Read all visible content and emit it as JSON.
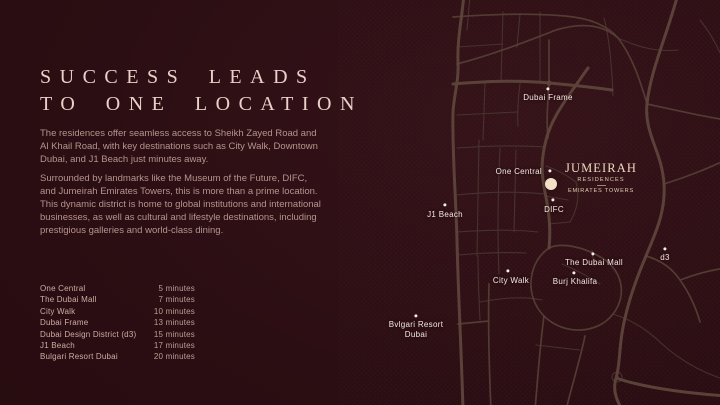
{
  "colors": {
    "background": "#2b0e13",
    "headline_text": "#e9d0c9",
    "body_text": "#b6948d",
    "road": "#5e453b",
    "map_label": "#f3e9e2",
    "brand_cream": "#f2e1c6"
  },
  "headline": {
    "line1": "SUCCESS LEADS",
    "line2": "TO ONE LOCATION"
  },
  "intro": {
    "p1": "The residences offer seamless access to Sheikh Zayed Road and\nAl Khail Road, with key destinations such as City Walk, Downtown\nDubai, and J1 Beach just minutes away.",
    "p2": "Surrounded by landmarks like the Museum of the Future, DIFC,\nand Jumeirah Emirates Towers, this is more than a prime location.\nThis dynamic district is home to global institutions and international\nbusinesses, as well as cultural and lifestyle destinations, including\nprestigious galleries and world-class dining."
  },
  "travel_times": {
    "items": [
      {
        "name": "One Central",
        "time": "5 minutes"
      },
      {
        "name": "The Dubai Mall",
        "time": "7 minutes"
      },
      {
        "name": "City Walk",
        "time": "10 minutes"
      },
      {
        "name": "Dubai Frame",
        "time": "13 minutes"
      },
      {
        "name": "Dubai Design District (d3)",
        "time": "15 minutes"
      },
      {
        "name": "J1 Beach",
        "time": "17 minutes"
      },
      {
        "name": "Bulgari Resort Dubai",
        "time": "20 minutes"
      }
    ]
  },
  "map": {
    "labels": {
      "dubai_frame": "Dubai Frame",
      "one_central": "One Central",
      "difc": "DIFC",
      "j1_beach": "J1 Beach",
      "city_walk": "City Walk",
      "the_dubai_mall": "The Dubai Mall",
      "burj_khalifa": "Burj Khalifa",
      "d3": "d3",
      "bulgari": "Bvlgari Resort\nDubai"
    },
    "logo": {
      "name": "JUMEIRAH",
      "sub1": "RESIDENCES",
      "sub2": "EMIRATES TOWERS"
    }
  }
}
